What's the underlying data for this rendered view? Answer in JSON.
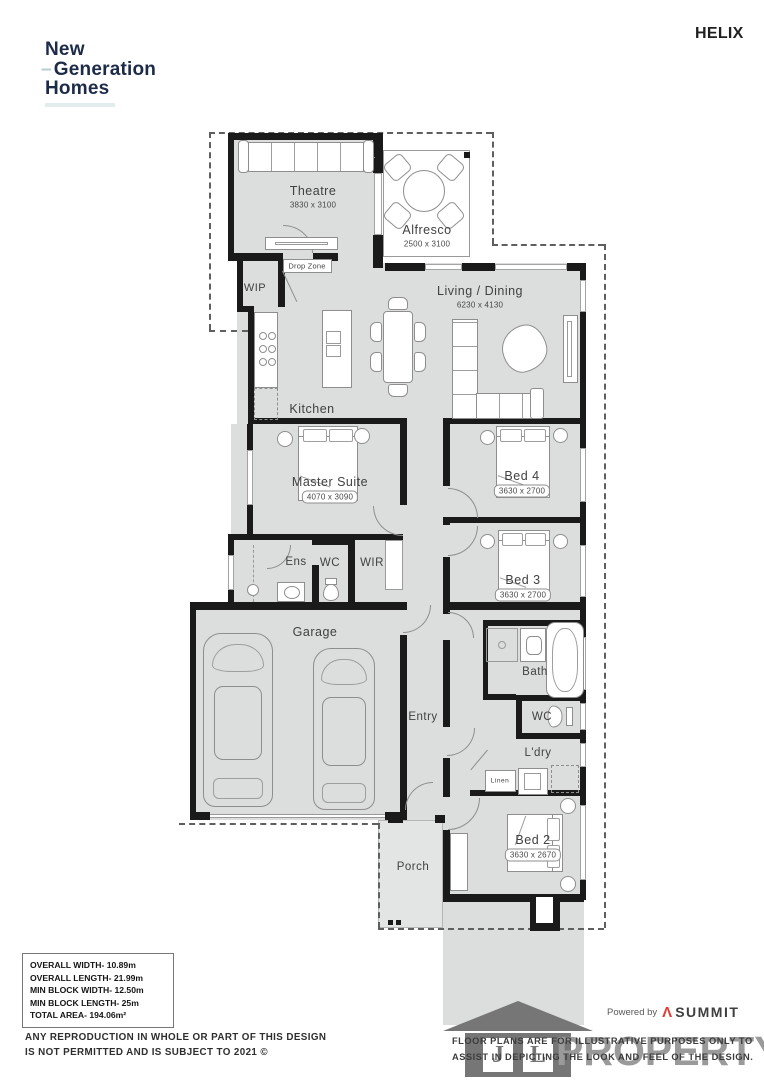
{
  "header": {
    "brand": {
      "line1": "New",
      "dash": "–",
      "line2": "Generation",
      "line3": "Homes"
    },
    "plan_name": "HELIX"
  },
  "rooms": {
    "theatre": {
      "label": "Theatre",
      "dims": "3830 x 3100"
    },
    "alfresco": {
      "label": "Alfresco",
      "dims": "2500 x 3100"
    },
    "living": {
      "label": "Living / Dining",
      "dims": "6230 x 4130"
    },
    "kitchen": {
      "label": "Kitchen"
    },
    "wip": {
      "label": "WIP"
    },
    "drop_zone": {
      "label": "Drop Zone"
    },
    "master": {
      "label": "Master Suite",
      "dims": "4070 x 3090"
    },
    "bed4": {
      "label": "Bed 4",
      "dims": "3630 x 2700"
    },
    "bed3": {
      "label": "Bed 3",
      "dims": "3630 x 2700"
    },
    "ens": {
      "label": "Ens"
    },
    "wc_ens": {
      "label": "WC"
    },
    "wir": {
      "label": "WIR"
    },
    "garage": {
      "label": "Garage"
    },
    "entry": {
      "label": "Entry"
    },
    "bath": {
      "label": "Bath"
    },
    "wc_main": {
      "label": "WC"
    },
    "ldry": {
      "label": "L'dry"
    },
    "linen": {
      "label": "Linen"
    },
    "bed2": {
      "label": "Bed 2",
      "dims": "3630 x 2670"
    },
    "porch": {
      "label": "Porch"
    }
  },
  "specs": {
    "lines": [
      "OVERALL WIDTH- 10.89m",
      "OVERALL LENGTH- 21.99m",
      "MIN BLOCK WIDTH- 12.50m",
      "MIN BLOCK LENGTH- 25m",
      "TOTAL AREA- 194.06m²"
    ]
  },
  "disclaimer": {
    "line1": "ANY REPRODUCTION IN WHOLE OR PART OF THIS DESIGN",
    "line2": "IS NOT PERMITTED AND IS SUBJECT TO 2021 ©"
  },
  "footer": {
    "powered_by": "Powered by",
    "summit_glyph": "Λ",
    "summit": "SUMMIT",
    "note_line1": "FLOOR PLANS ARE FOR ILLUSTRATIVE PURPOSES ONLY TO",
    "note_line2": "ASSIST IN DEPICTING THE LOOK AND FEEL OF THE DESIGN.",
    "watermark_word": "PROPERTY",
    "watermark_letters": {
      "left": "J",
      "right": "L"
    }
  },
  "colors": {
    "brand_navy": "#1d2b49",
    "brand_teal": "#b5cdd0",
    "summit_red": "#e03c31",
    "wall": "#1a1a1a",
    "floor": "#dcdddd"
  }
}
